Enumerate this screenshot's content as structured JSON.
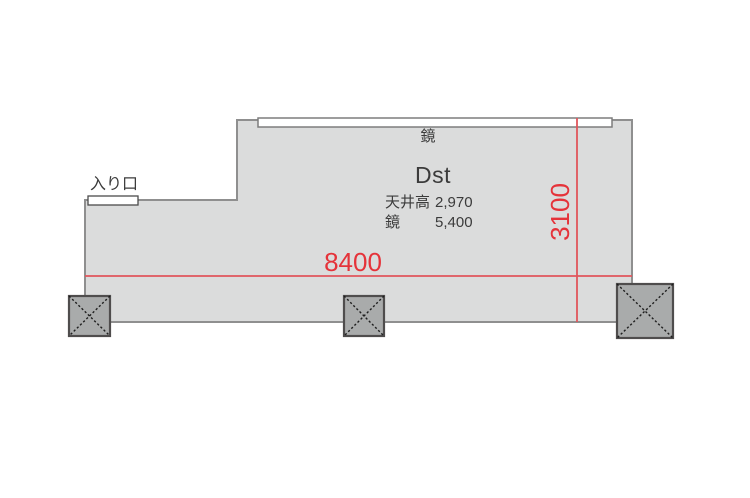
{
  "floorplan": {
    "entrance_label": "入り口",
    "mirror_label": "鏡",
    "room": {
      "name": "Dst",
      "specs": [
        {
          "label": "天井高",
          "value": "2,970"
        },
        {
          "label": "鏡",
          "value": "5,400"
        }
      ]
    },
    "dimensions": {
      "width_mm": "8400",
      "depth_mm": "3100"
    },
    "colors": {
      "page_bg": "#ffffff",
      "room_fill": "#dbdcdc",
      "wall_stroke": "#8f8f8f",
      "fixture_fill": "#ffffff",
      "mirror_border": "#7d7d7d",
      "door_border": "#4c4c4c",
      "dimension_line": "#e0565c",
      "dimension_text": "#e5333a",
      "column_fill": "#a9abab",
      "column_border": "#4f4d4d",
      "column_cross": "#1f1f1f",
      "text_dark": "#3b3b3b"
    }
  }
}
